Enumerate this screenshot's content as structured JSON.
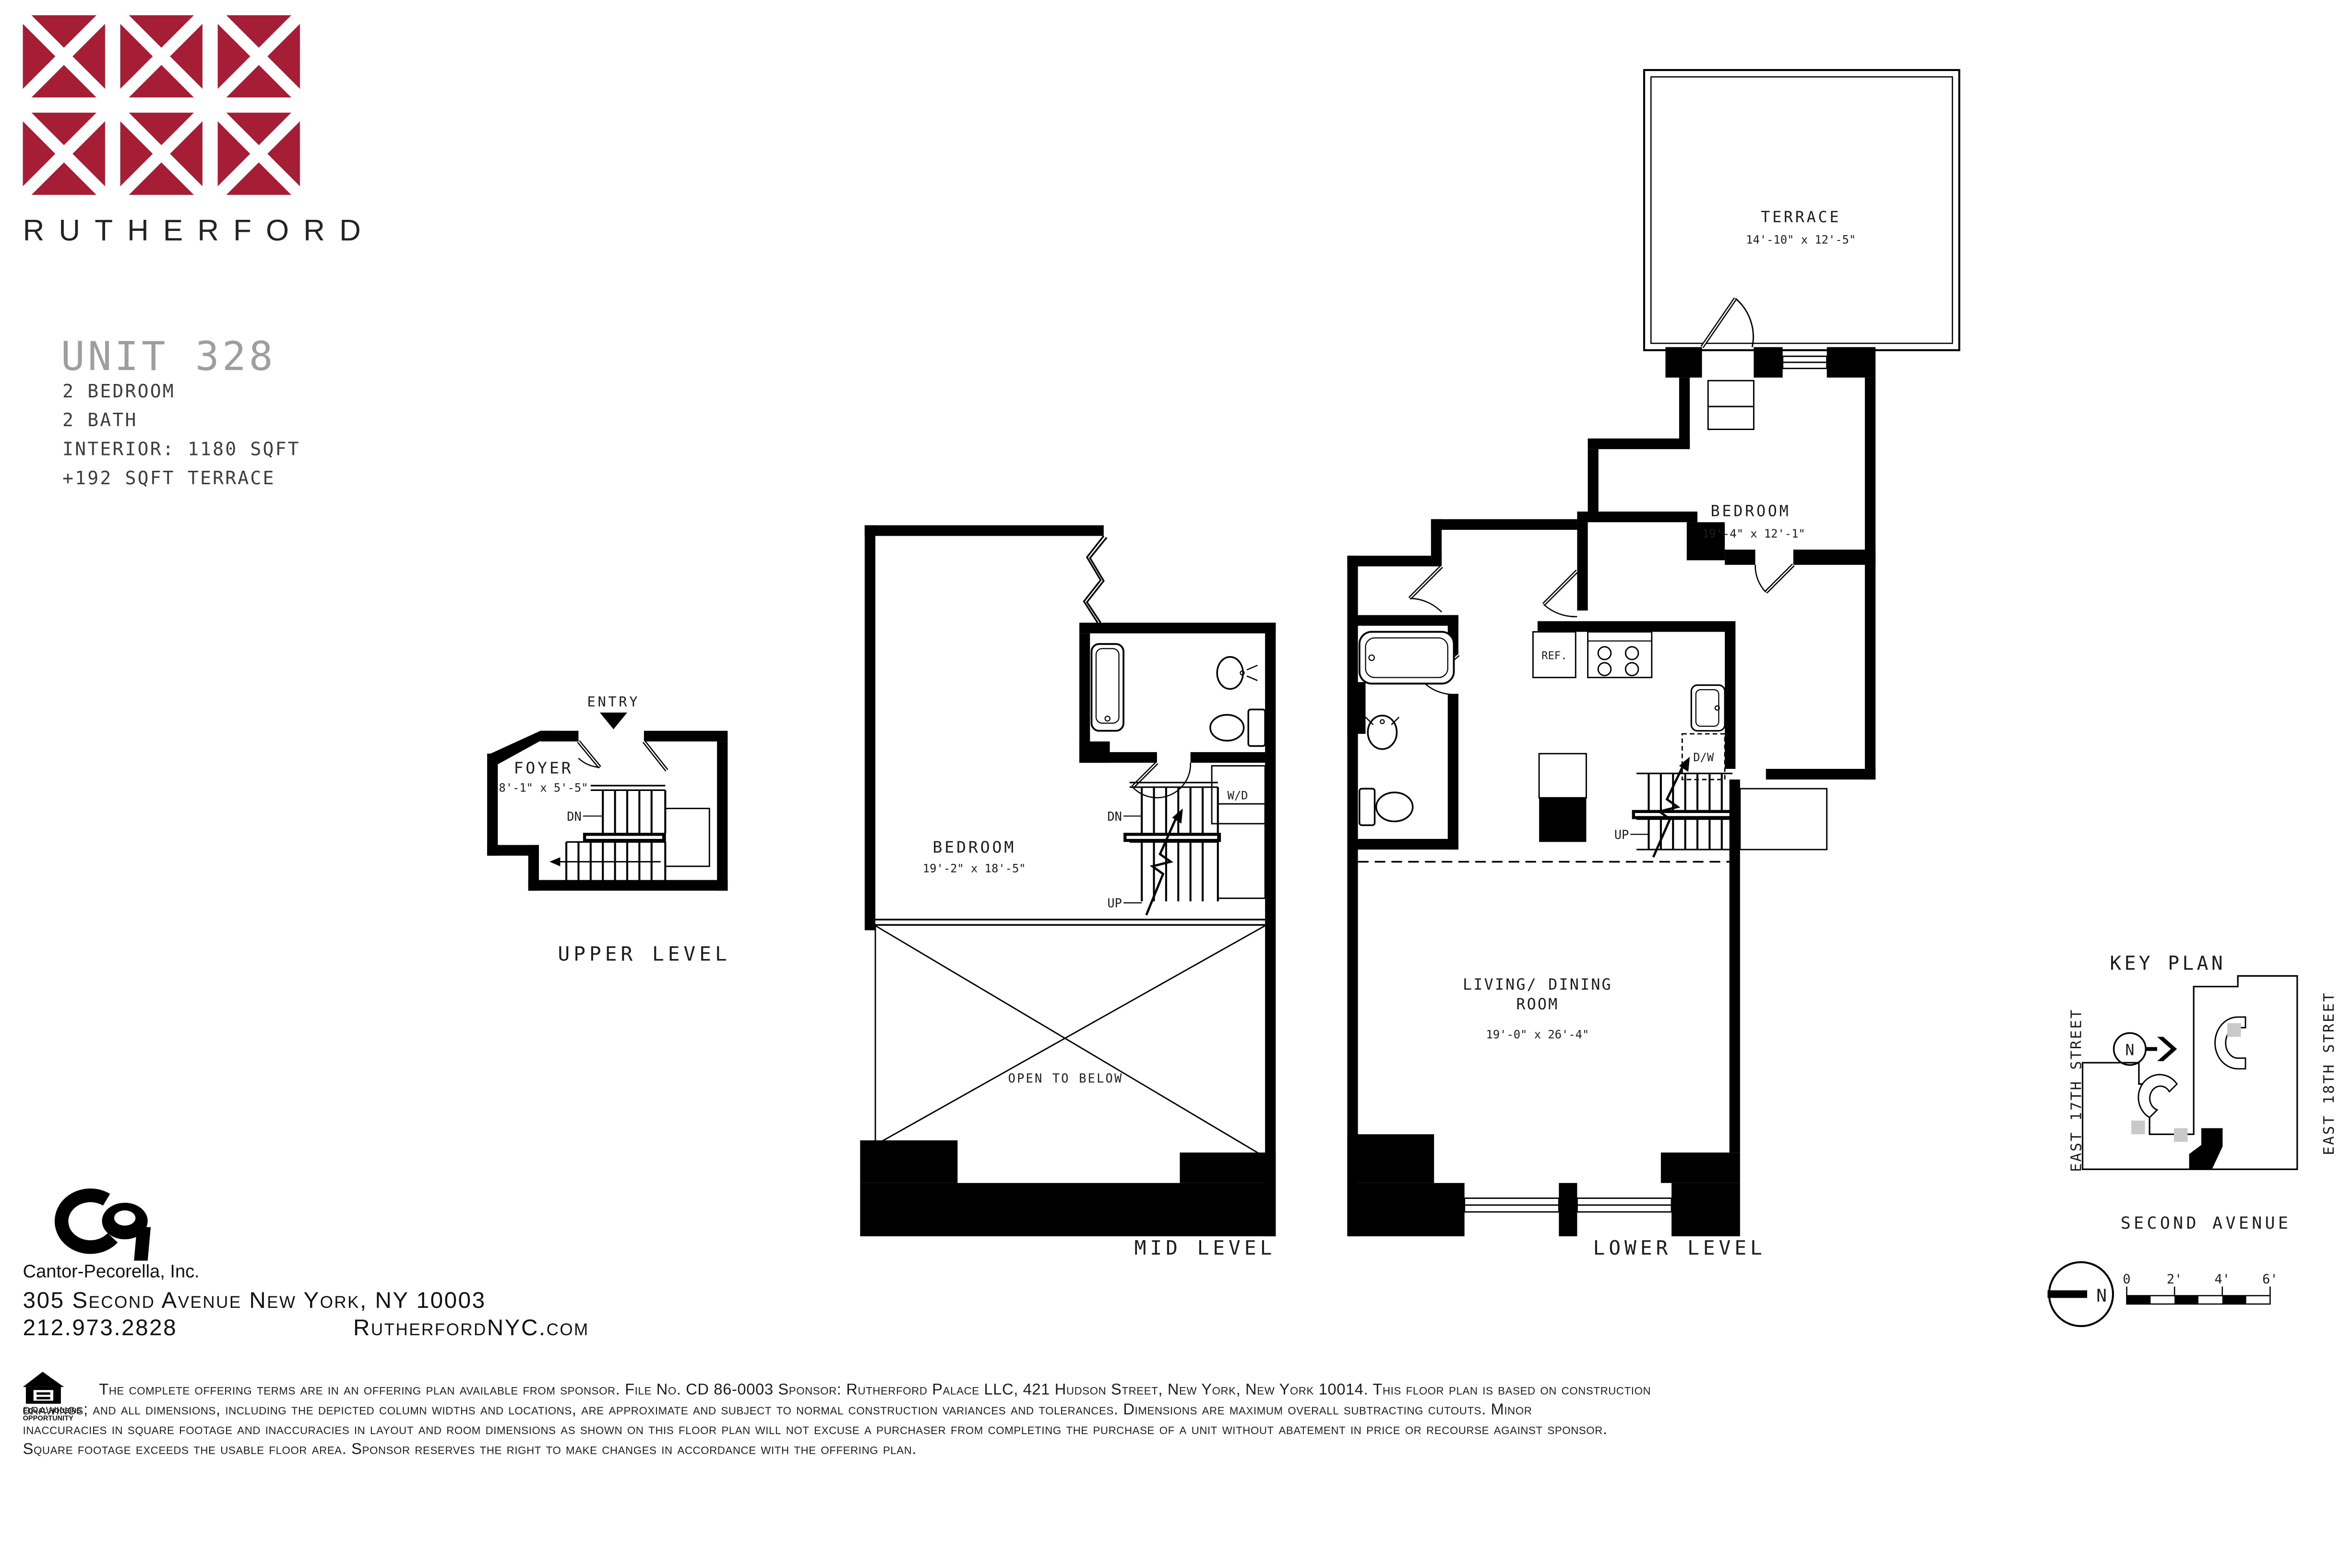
{
  "colors": {
    "accent": "#A51E36",
    "wall": "#000000",
    "muted": "#9e9e9e"
  },
  "brand": {
    "name": "RUTHERFORD"
  },
  "unit": {
    "title": "UNIT 328",
    "details": [
      "2 BEDROOM",
      "2 BATH",
      "INTERIOR: 1180 SQFT",
      "+192 SQFT TERRACE"
    ]
  },
  "plans": {
    "upper": {
      "caption": "UPPER LEVEL",
      "entry_label": "ENTRY",
      "room_name": "FOYER",
      "room_dims": "8'-1\" x 5'-5\"",
      "dn_label": "DN"
    },
    "mid": {
      "caption": "MID LEVEL",
      "room_name": "BEDROOM",
      "room_dims": "19'-2\" x 18'-5\"",
      "open_label": "OPEN TO BELOW",
      "wd_label": "W/D",
      "dn_label": "DN",
      "up_label": "UP"
    },
    "lower": {
      "caption": "LOWER LEVEL",
      "terrace_name": "TERRACE",
      "terrace_dims": "14'-10\" x 12'-5\"",
      "bedroom_name": "BEDROOM",
      "bedroom_dims": "19'-4\" x 12'-1\"",
      "living_line1": "LIVING/ DINING",
      "living_line2": "ROOM",
      "living_dims": "19'-0\" x 26'-4\"",
      "ref_label": "REF.",
      "dw_label": "D/W",
      "up_label": "UP"
    }
  },
  "key_plan": {
    "title": "KEY PLAN",
    "street_left": "EAST 17TH STREET",
    "street_right": "EAST 18TH STREET",
    "street_bottom": "SECOND AVENUE",
    "north_label": "N"
  },
  "scale_bar": {
    "north_label": "N",
    "ticks": [
      "0",
      "2'",
      "4'",
      "6'"
    ]
  },
  "footer": {
    "firm": "Cantor-Pecorella, Inc.",
    "address": "305 Second Avenue New York, NY 10003",
    "phone": "212.973.2828",
    "website": "RutherfordNYC.com"
  },
  "legal": {
    "eho_line1": "EQUAL HOUSING",
    "eho_line2": "OPPORTUNITY",
    "lines": [
      "The complete offering terms are in an offering plan available from sponsor. File No.  CD 86-0003 Sponsor: Rutherford Palace LLC, 421 Hudson Street, New York, New York 10014. This floor plan is based on construction",
      "drawings; and all dimensions, including the depicted column widths and locations, are approximate and subject to normal construction variances and tolerances. Dimensions are maximum overall subtracting cutouts. Minor",
      "inaccuracies in square footage and inaccuracies in layout and room dimensions as shown on this floor plan will not excuse a purchaser from completing the purchase of a unit without abatement in price or recourse against sponsor.",
      "Square footage exceeds the usable floor area. Sponsor reserves the right to make changes in accordance with the offering plan."
    ]
  }
}
